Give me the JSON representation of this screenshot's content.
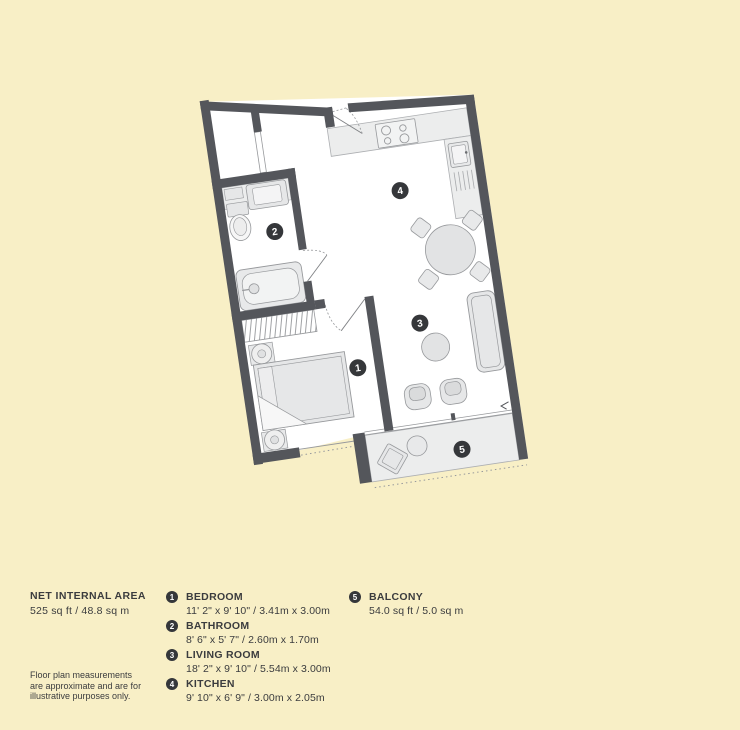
{
  "net_area": {
    "title": "NET INTERNAL AREA",
    "value": "525 sq ft / 48.8 sq m"
  },
  "rooms": [
    {
      "num": "1",
      "name": "BEDROOM",
      "dims": "11' 2\" x 9' 10\" / 3.41m x 3.00m"
    },
    {
      "num": "2",
      "name": "BATHROOM",
      "dims": "8' 6\" x 5' 7\" / 2.60m x 1.70m"
    },
    {
      "num": "3",
      "name": "LIVING ROOM",
      "dims": "18' 2\" x 9' 10\" / 5.54m x 3.00m"
    },
    {
      "num": "4",
      "name": "KITCHEN",
      "dims": "9' 10\" x 6' 9\" / 3.00m x 2.05m"
    },
    {
      "num": "5",
      "name": "BALCONY",
      "dims": "54.0 sq ft / 5.0 sq m"
    }
  ],
  "disclaimer": {
    "line1": "Floor plan measurements",
    "line2": "are approximate and are for",
    "line3": "illustrative purposes only."
  },
  "colors": {
    "background": "#F8EFC6",
    "walls": "#54565B",
    "text": "#3B3C3E",
    "badge": "#35373A",
    "furniture_fill": "#E6E7E8",
    "furniture_line": "#97999C"
  }
}
